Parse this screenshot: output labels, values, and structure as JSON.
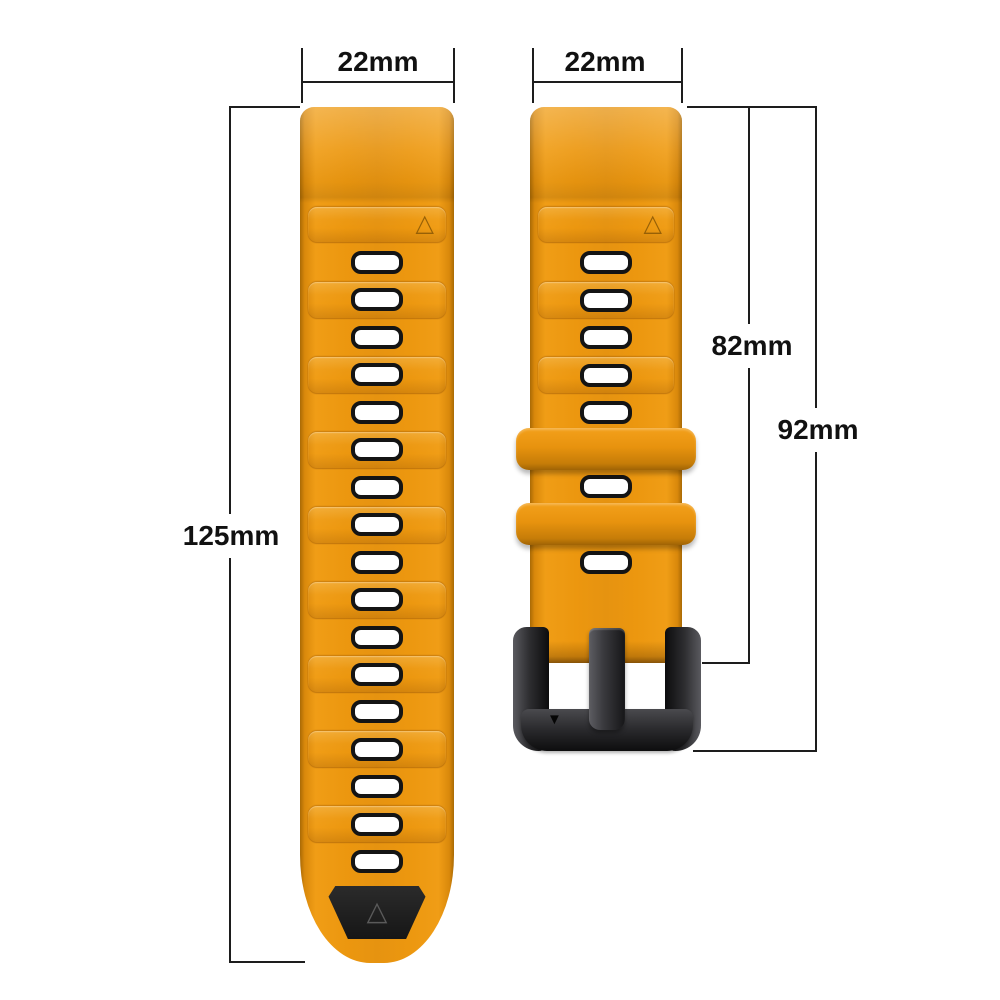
{
  "title": "Watch strap dimension diagram",
  "colors": {
    "background": "#ffffff",
    "strap_orange": "#e6930e",
    "strap_orange_light": "#f09d16",
    "strap_orange_dark": "#a96a05",
    "hole_fill": "#ffffff",
    "hole_border": "#141414",
    "tip_patch_black": "#1c1c1c",
    "buckle_metal": "#2e2e31",
    "dimension_line": "#1d1d1d",
    "label_text": "#111111"
  },
  "dimensions": {
    "left_strap_width": "22mm",
    "right_strap_width": "22mm",
    "left_strap_length": "125mm",
    "right_strap_length_to_buckle": "82mm",
    "right_strap_length_total": "92mm"
  },
  "icons": {
    "triangle_up_outline": "△",
    "triangle_down_filled": "▼"
  },
  "straps": {
    "left": {
      "hole_count": 17,
      "band_count": 8,
      "has_black_tip": true,
      "triangle_marks": 2
    },
    "right": {
      "hole_count": 7,
      "band_count": 2,
      "keeper_count": 2,
      "has_buckle": true,
      "triangle_marks": 2
    }
  }
}
